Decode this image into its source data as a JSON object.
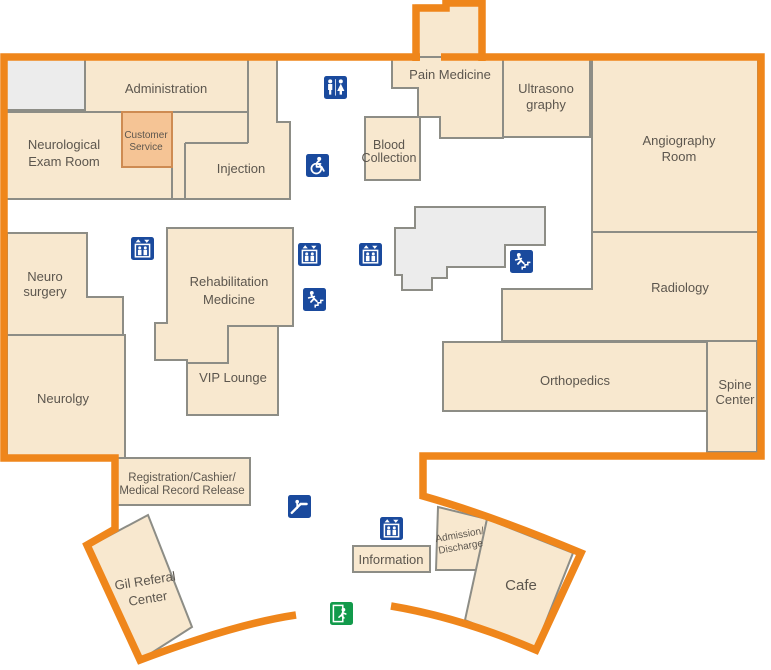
{
  "map_title": "Hospital first floor map",
  "rooms": {
    "administration": {
      "label": "Administration"
    },
    "neurological_exam_room": {
      "line1": "Neurological",
      "line2": "Exam Room"
    },
    "customer_service": {
      "line1": "Customer",
      "line2": "Service"
    },
    "injection": {
      "label": "Injection"
    },
    "pain_medicine": {
      "label": "Pain Medicine"
    },
    "blood_collection": {
      "line1": "Blood",
      "line2": "Collection"
    },
    "ultrasonography": {
      "line1": "Ultrasono",
      "line2": "graphy"
    },
    "angiography_room": {
      "line1": "Angiography",
      "line2": "Room"
    },
    "radiology": {
      "label": "Radiology"
    },
    "orthopedics": {
      "label": "Orthopedics"
    },
    "spine_center": {
      "line1": "Spine",
      "line2": "Center"
    },
    "neuro_surgery": {
      "line1": "Neuro",
      "line2": "surgery"
    },
    "neurology": {
      "label": "Neurolgy"
    },
    "rehabilitation_medicine": {
      "line1": "Rehabilitation",
      "line2": "Medicine"
    },
    "vip_lounge": {
      "label": "VIP Lounge"
    },
    "registration": {
      "line1": "Registration/Cashier/",
      "line2": "Medical Record Release"
    },
    "gil_referral_center": {
      "line1": "Gil Referal",
      "line2": "Center"
    },
    "information": {
      "label": "Information"
    },
    "admission_discharge": {
      "line1": "Admission/",
      "line2": "Discharge"
    },
    "cafe": {
      "label": "Cafe"
    }
  },
  "icons": {
    "restroom": "restroom-icon",
    "wheelchair": "wheelchair-accessible-icon",
    "elevator": "elevator-icon",
    "emergency_stairs": "emergency-stairs-icon",
    "escalator": "escalator-icon",
    "emergency_exit": "emergency-exit-icon"
  },
  "colors": {
    "building_outline": "#EF861B",
    "room_fill": "#F8E8CF",
    "room_stroke": "#8D8D86",
    "highlight_room_fill": "#F5C495",
    "highlight_room_stroke": "#CE8B52",
    "service_core_fill": "#ECECEC",
    "icon_blue": "#1A4A9D",
    "icon_green": "#129A4B",
    "label_color": "#5C564E",
    "background": "#FFFFFF"
  }
}
